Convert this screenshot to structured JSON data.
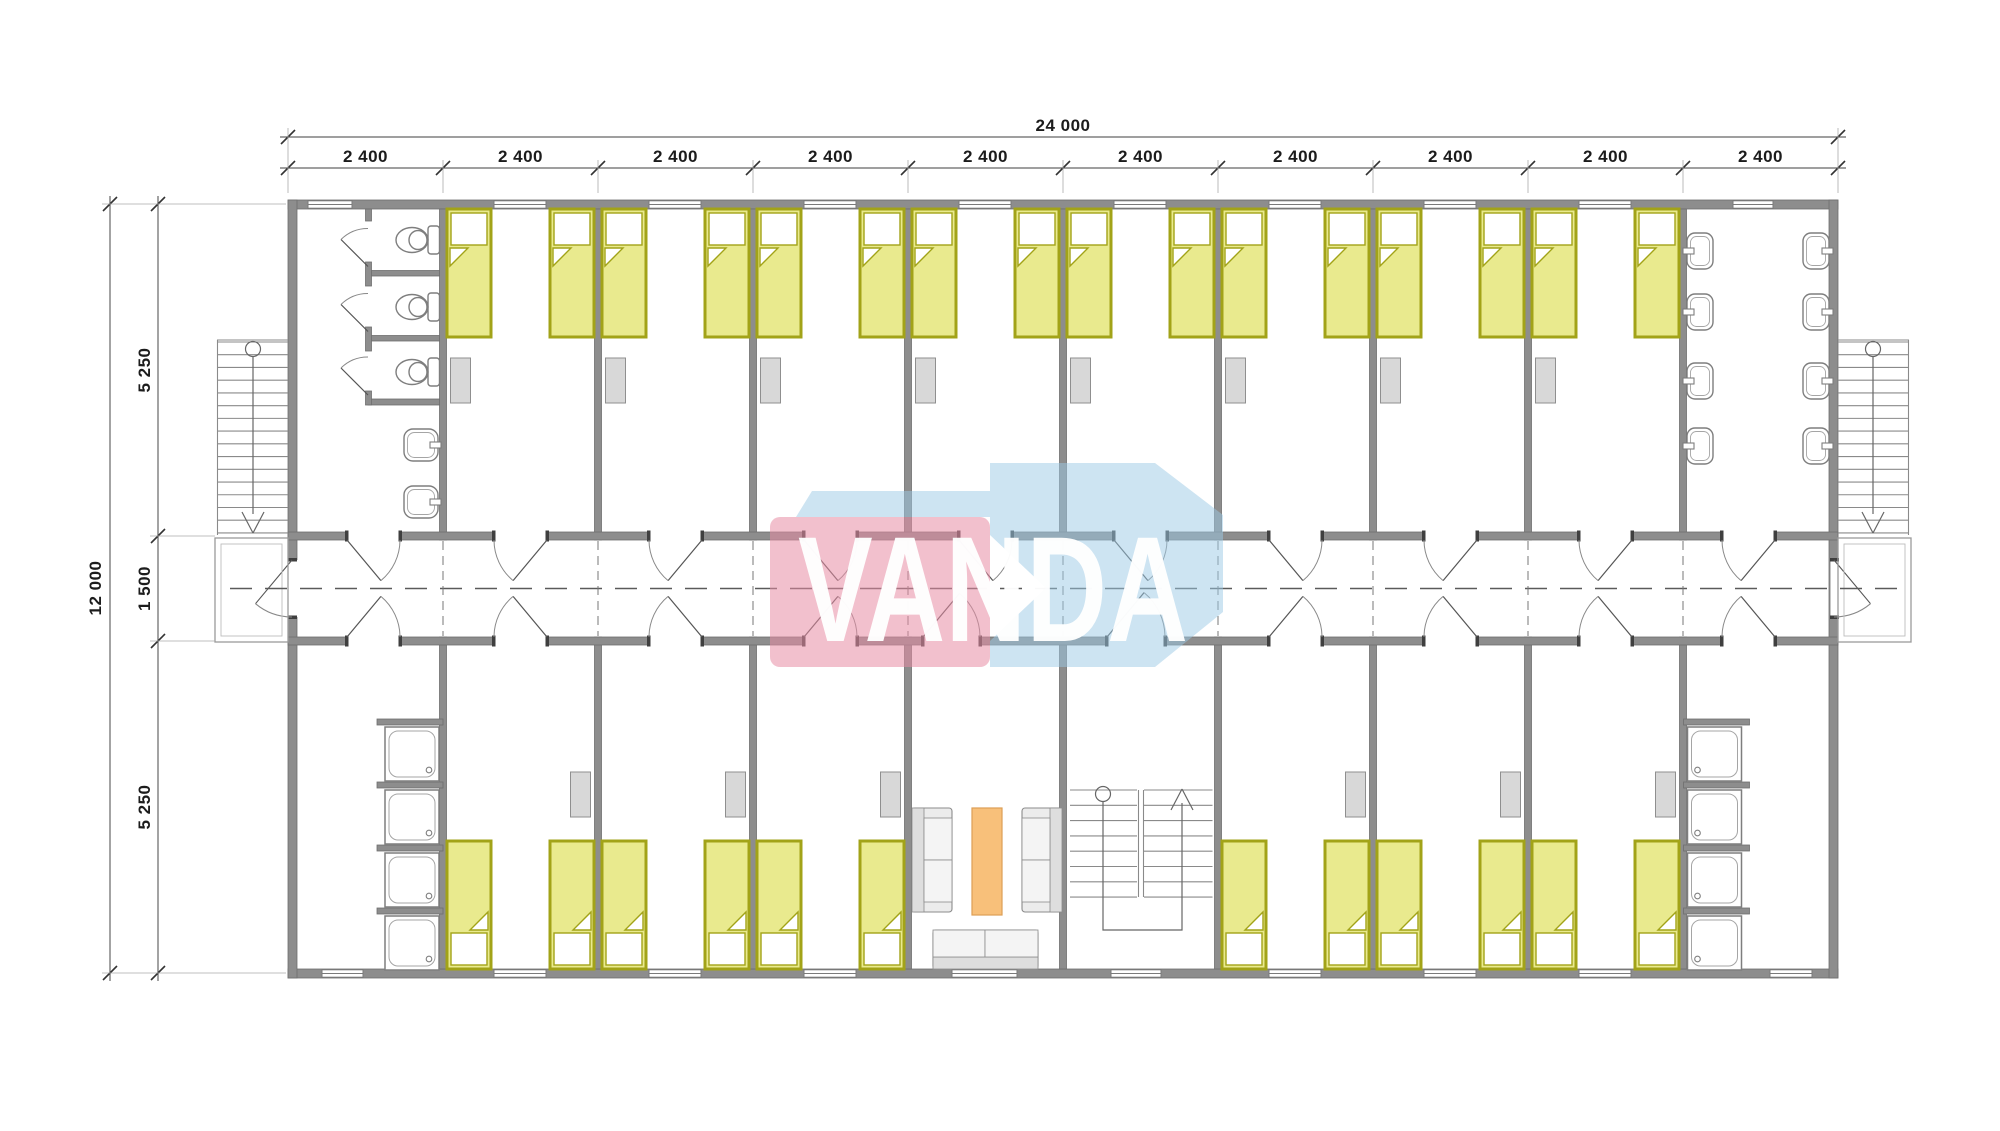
{
  "logo": {
    "text": "VANDA",
    "pink_color": "#e88ca4",
    "blue_color": "#9bc9e5"
  },
  "dimensions": {
    "top_total": "24 000",
    "top_segments": [
      "2 400",
      "2 400",
      "2 400",
      "2 400",
      "2 400",
      "2 400",
      "2 400",
      "2 400",
      "2 400",
      "2 400"
    ],
    "left_total": "12 000",
    "left_segments": [
      "5 250",
      "1 500",
      "5 250"
    ]
  },
  "plan": {
    "bays_top": [
      "toilet-room",
      "bedroom",
      "bedroom",
      "bedroom",
      "bedroom",
      "bedroom",
      "bedroom",
      "bedroom",
      "bedroom",
      "washroom"
    ],
    "bays_bottom": [
      "shower-room",
      "bedroom",
      "bedroom",
      "bedroom",
      "lounge",
      "staircase",
      "bedroom",
      "bedroom",
      "bedroom",
      "shower-room"
    ],
    "fixtures": {
      "toilets": 3,
      "wc_sinks": 2,
      "washroom_sinks": 8,
      "showers_per_room": 4,
      "beds_top_row": 16,
      "beds_bottom_row": 12,
      "sofas": 3,
      "coffee_tables": 1,
      "exterior_stairs": 2,
      "interior_stairs": 1
    }
  },
  "colors": {
    "wall": "#8d8d8d",
    "wall_edge": "#6f6f6f",
    "bed_fill": "#e9ea8e",
    "bed_border": "#a2a318",
    "wardrobe": "#d8d8d8",
    "sofa": "#ececec",
    "table": "#f8c07a",
    "table_border": "#dd9e55",
    "fixture_line": "#7e7e7e",
    "thin_line": "#8a8a8a",
    "dash_line": "#5a5a5a"
  }
}
